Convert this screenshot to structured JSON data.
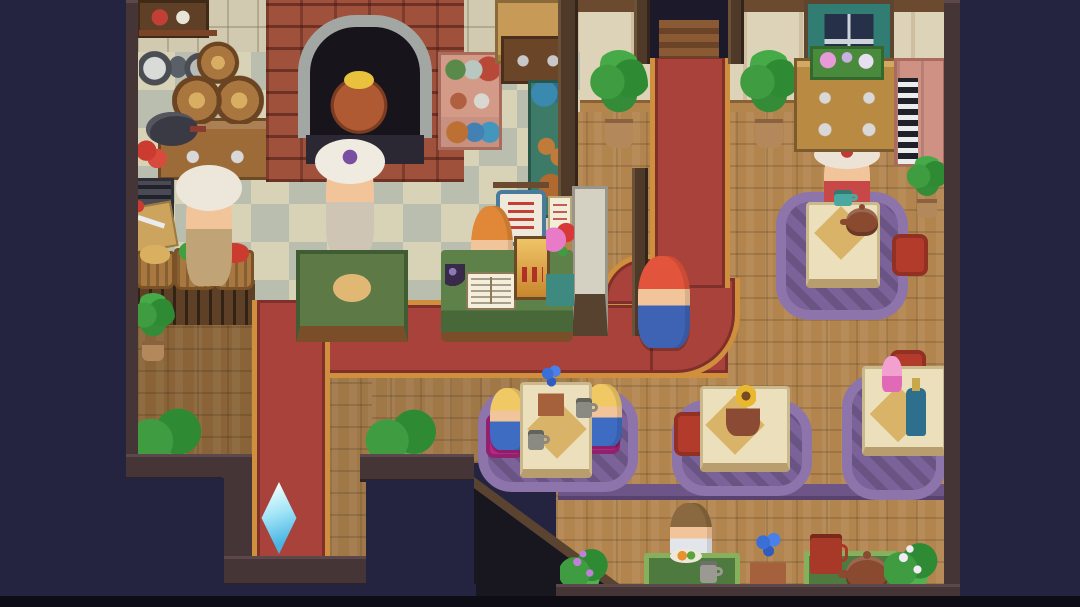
{
  "meta": {
    "scene": "pixel-art cafe-bakery interior, top-down RPG view",
    "canvas": {
      "w": 1080,
      "h": 607
    },
    "background": "#242440"
  },
  "palette": {
    "outside_navy": "#242440",
    "carpet_red": "#a8423a",
    "carpet_gold": "#cf8f3c",
    "wood_floor": "#b3854e",
    "wood_floor_mid": "#a07848",
    "wood_floor_dark": "#8a6438",
    "checker_cream": "#d8d2b6",
    "checker_gray": "#b9beae",
    "rug_purple": "#7b6299",
    "table_cream": "#ecdfbb",
    "cushion_red": "#b23b2c",
    "cushion_magenta": "#b32886",
    "mat_green": "#4e7a40",
    "crystal_cyan": "#9fe4f6",
    "border_wall": "#463536"
  },
  "sprites": [
    {
      "name": "kitchen-backsplash-wall",
      "kind": "wall-tile",
      "x": 137,
      "y": 0,
      "w": 443,
      "h": 118,
      "i": false
    },
    {
      "name": "dining-wall",
      "kind": "wall-panel",
      "x": 575,
      "y": 0,
      "w": 370,
      "h": 118,
      "i": false
    },
    {
      "name": "ceiling-beam",
      "kind": "beam",
      "x": 575,
      "y": 0,
      "w": 370,
      "h": 12,
      "i": false
    },
    {
      "name": "dining-baseboard",
      "kind": "baseboard",
      "x": 575,
      "y": 100,
      "w": 370,
      "h": 18,
      "i": false
    },
    {
      "name": "kitchen-checker-floor",
      "kind": "floor-checker",
      "x": 137,
      "y": 52,
      "w": 443,
      "h": 251,
      "i": false
    },
    {
      "name": "dining-wood-floor",
      "kind": "floor-wood",
      "x": 556,
      "y": 112,
      "w": 389,
      "h": 473,
      "i": false,
      "c": {
        "c1": "#b3854e"
      }
    },
    {
      "name": "mid-wood-floor",
      "kind": "floor-wood",
      "x": 330,
      "y": 375,
      "w": 250,
      "h": 88,
      "i": false,
      "c": {
        "c1": "#a07848"
      }
    },
    {
      "name": "branchside-wood-floor",
      "kind": "floor-wood",
      "x": 330,
      "y": 375,
      "w": 42,
      "h": 185,
      "i": false,
      "c": {
        "c1": "#a07848"
      }
    },
    {
      "name": "left-wood-floor",
      "kind": "floor-wood",
      "x": 137,
      "y": 300,
      "w": 115,
      "h": 160,
      "i": false,
      "c": {
        "c1": "#8a6438"
      }
    },
    {
      "name": "veg-counter-kickpanel",
      "kind": "counter-front",
      "x": 137,
      "y": 280,
      "w": 118,
      "h": 45,
      "i": false
    },
    {
      "name": "carpet-horizontal",
      "kind": "carpet carpet-h",
      "x": 252,
      "y": 300,
      "w": 476,
      "h": 78,
      "i": false
    },
    {
      "name": "carpet-outer-corner",
      "kind": "carpet carpet-corner",
      "x": 650,
      "y": 278,
      "w": 90,
      "h": 100,
      "i": false
    },
    {
      "name": "carpet-inner-curve",
      "kind": "carpet carpet-innercurve",
      "x": 600,
      "y": 254,
      "w": 52,
      "h": 50,
      "i": false
    },
    {
      "name": "carpet-vertical",
      "kind": "carpet carpet-v",
      "x": 650,
      "y": 56,
      "w": 80,
      "h": 232,
      "i": false
    },
    {
      "name": "carpet-south-branch",
      "kind": "carpet carpet-branch",
      "x": 252,
      "y": 300,
      "w": 78,
      "h": 260,
      "i": false
    },
    {
      "name": "booth-valance",
      "kind": "valance-strip",
      "x": 558,
      "y": 484,
      "w": 388,
      "h": 16,
      "i": false
    },
    {
      "name": "stairwell-void",
      "kind": "void-stairs",
      "x": 470,
      "y": 480,
      "w": 172,
      "h": 127,
      "i": false
    },
    {
      "name": "stairwell-edge",
      "kind": "diag-edge",
      "x": 470,
      "y": 474,
      "w": 214,
      "h": 9,
      "i": false
    },
    {
      "name": "rug-table-northeast",
      "kind": "rug",
      "x": 776,
      "y": 192,
      "w": 132,
      "h": 128,
      "i": false
    },
    {
      "name": "npc-fancy-lady",
      "kind": "char-hat",
      "x": 824,
      "y": 144,
      "w": 46,
      "h": 74,
      "i": true,
      "c": {
        "hair": "#ece2d6",
        "body": "#c84848",
        "trim": "#c03838"
      }
    },
    {
      "name": "table-northeast",
      "kind": "table",
      "x": 806,
      "y": 202,
      "w": 74,
      "h": 86,
      "i": false
    },
    {
      "name": "placemat-northeast",
      "kind": "diamond",
      "x": 822,
      "y": 214,
      "w": 38,
      "h": 38,
      "i": false
    },
    {
      "name": "teacup-lady",
      "kind": "mug",
      "x": 834,
      "y": 190,
      "w": 18,
      "h": 16,
      "i": false,
      "c": {
        "c1": "#4aa8a0"
      }
    },
    {
      "name": "teapot-northeast",
      "kind": "pot",
      "x": 846,
      "y": 208,
      "w": 32,
      "h": 28,
      "i": false,
      "c": {
        "c1": "#8a4a30"
      }
    },
    {
      "name": "cushion-northeast",
      "kind": "cushion",
      "x": 892,
      "y": 234,
      "w": 36,
      "h": 42,
      "i": false,
      "c": {
        "c1": "#b23b2c"
      }
    },
    {
      "name": "rug-table-twins",
      "kind": "rug",
      "x": 478,
      "y": 390,
      "w": 160,
      "h": 102,
      "i": false
    },
    {
      "name": "cushion-twin-left",
      "kind": "cushion",
      "x": 486,
      "y": 414,
      "w": 38,
      "h": 44,
      "i": false,
      "c": {
        "c1": "#b32886"
      }
    },
    {
      "name": "cushion-twin-right",
      "kind": "cushion",
      "x": 582,
      "y": 410,
      "w": 38,
      "h": 44,
      "i": false,
      "c": {
        "c1": "#b32886"
      }
    },
    {
      "name": "npc-twin-girl-left",
      "kind": "char",
      "x": 490,
      "y": 388,
      "w": 38,
      "h": 62,
      "i": true,
      "c": {
        "hair": "#f0c864",
        "body": "#3e6cc2"
      }
    },
    {
      "name": "npc-twin-girl-right",
      "kind": "char",
      "x": 584,
      "y": 384,
      "w": 38,
      "h": 62,
      "i": true,
      "c": {
        "hair": "#f0c864",
        "body": "#3e6cc2"
      }
    },
    {
      "name": "table-twins",
      "kind": "table",
      "x": 520,
      "y": 382,
      "w": 72,
      "h": 96,
      "i": false
    },
    {
      "name": "placemat-twins",
      "kind": "diamond",
      "x": 536,
      "y": 408,
      "w": 42,
      "h": 42,
      "i": false
    },
    {
      "name": "flower-vase-twins",
      "kind": "vase-blue",
      "x": 538,
      "y": 362,
      "w": 26,
      "h": 54,
      "i": false
    },
    {
      "name": "mug-twin-right",
      "kind": "mug",
      "x": 576,
      "y": 398,
      "w": 16,
      "h": 20,
      "i": false,
      "c": {
        "c1": "#8a8a82"
      }
    },
    {
      "name": "mug-twin-left",
      "kind": "mug",
      "x": 528,
      "y": 430,
      "w": 16,
      "h": 20,
      "i": false,
      "c": {
        "c1": "#8a8a82"
      }
    },
    {
      "name": "rug-table-sunflower",
      "kind": "rug",
      "x": 672,
      "y": 400,
      "w": 140,
      "h": 96,
      "i": false
    },
    {
      "name": "cushion-sunflower",
      "kind": "cushion",
      "x": 674,
      "y": 412,
      "w": 38,
      "h": 44,
      "i": false,
      "c": {
        "c1": "#b23b2c"
      }
    },
    {
      "name": "table-sunflower",
      "kind": "table",
      "x": 700,
      "y": 386,
      "w": 90,
      "h": 86,
      "i": false
    },
    {
      "name": "placemat-sunflower",
      "kind": "diamond",
      "x": 714,
      "y": 404,
      "w": 42,
      "h": 42,
      "i": false
    },
    {
      "name": "sunflower-vase",
      "kind": "vase-sun",
      "x": 726,
      "y": 390,
      "w": 34,
      "h": 46,
      "i": false
    },
    {
      "name": "rug-table-parfait",
      "kind": "rug",
      "x": 842,
      "y": 374,
      "w": 104,
      "h": 126,
      "i": false
    },
    {
      "name": "cushion-parfait",
      "kind": "cushion",
      "x": 890,
      "y": 350,
      "w": 36,
      "h": 26,
      "i": false,
      "c": {
        "c1": "#b23b2c"
      }
    },
    {
      "name": "table-parfait",
      "kind": "table",
      "x": 862,
      "y": 366,
      "w": 84,
      "h": 90,
      "i": false
    },
    {
      "name": "placemat-parfait",
      "kind": "diamond",
      "x": 878,
      "y": 394,
      "w": 40,
      "h": 40,
      "i": false
    },
    {
      "name": "parfait-drink",
      "kind": "parfait",
      "x": 882,
      "y": 356,
      "w": 20,
      "h": 36,
      "i": false
    },
    {
      "name": "wine-bottle",
      "kind": "bottle",
      "x": 906,
      "y": 388,
      "w": 20,
      "h": 48,
      "i": false,
      "c": {
        "c1": "#2e6f8e"
      }
    },
    {
      "name": "wall-shelf-topleft",
      "kind": "shelf-dark",
      "x": 137,
      "y": 0,
      "w": 72,
      "h": 38,
      "i": false
    },
    {
      "name": "utensil-rack",
      "kind": "utensils",
      "x": 139,
      "y": 30,
      "w": 78,
      "h": 66,
      "i": false
    },
    {
      "name": "left-counter",
      "kind": "counter-wood",
      "x": 158,
      "y": 118,
      "w": 112,
      "h": 62,
      "i": false
    },
    {
      "name": "wine-barrels",
      "kind": "barrels",
      "x": 172,
      "y": 40,
      "w": 92,
      "h": 84,
      "i": false
    },
    {
      "name": "frying-pan",
      "kind": "pan",
      "x": 146,
      "y": 112,
      "w": 52,
      "h": 34,
      "i": false
    },
    {
      "name": "tomato-pair",
      "kind": "tomatoes",
      "x": 136,
      "y": 140,
      "w": 32,
      "h": 28,
      "i": false
    },
    {
      "name": "floor-vent",
      "kind": "vent",
      "x": 126,
      "y": 178,
      "w": 48,
      "h": 64,
      "i": false
    },
    {
      "name": "cutting-board-knife",
      "kind": "board",
      "x": 131,
      "y": 204,
      "w": 44,
      "h": 46,
      "i": false
    },
    {
      "name": "basket-potatoes",
      "kind": "basket",
      "x": 135,
      "y": 251,
      "w": 40,
      "h": 38,
      "i": false,
      "c": {
        "veg": "#d8b060"
      }
    },
    {
      "name": "basket-cabbage",
      "kind": "basket",
      "x": 174,
      "y": 248,
      "w": 42,
      "h": 42,
      "i": false,
      "c": {
        "veg": "#3fa040"
      }
    },
    {
      "name": "basket-tomatoes",
      "kind": "basket",
      "x": 214,
      "y": 250,
      "w": 40,
      "h": 40,
      "i": false,
      "c": {
        "veg": "#cc3b30"
      }
    },
    {
      "name": "npc-head-chef",
      "kind": "char-hat",
      "x": 186,
      "y": 172,
      "w": 46,
      "h": 114,
      "i": true,
      "c": {
        "hair": "#ece7da",
        "body": "#c0a478"
      }
    },
    {
      "name": "brick-oven",
      "kind": "oven",
      "x": 266,
      "y": 0,
      "w": 198,
      "h": 182,
      "i": true
    },
    {
      "name": "copper-stew-pot",
      "kind": "pot-copper",
      "x": 322,
      "y": 66,
      "w": 74,
      "h": 68,
      "i": false
    },
    {
      "name": "npc-baker",
      "kind": "char-hat",
      "x": 326,
      "y": 146,
      "w": 48,
      "h": 112,
      "i": true,
      "c": {
        "hair": "#f0ebe0",
        "body": "#cfc5b4",
        "trim": "#7a4ea0"
      }
    },
    {
      "name": "prep-table",
      "kind": "prep-table",
      "x": 296,
      "y": 250,
      "w": 112,
      "h": 92,
      "i": false
    },
    {
      "name": "pink-jar-shelf",
      "kind": "shelf-pink",
      "x": 438,
      "y": 52,
      "w": 64,
      "h": 98,
      "i": false
    },
    {
      "name": "upper-cupboard",
      "kind": "cupboard",
      "x": 495,
      "y": 0,
      "w": 80,
      "h": 64,
      "i": false
    },
    {
      "name": "dark-cabinet",
      "kind": "cabinet-dark",
      "x": 501,
      "y": 36,
      "w": 74,
      "h": 48,
      "i": false
    },
    {
      "name": "bread-display-stand",
      "kind": "teal-bar",
      "x": 528,
      "y": 80,
      "w": 50,
      "h": 138,
      "i": false
    },
    {
      "name": "kitchen-door-post",
      "kind": "post-dark",
      "x": 558,
      "y": 0,
      "w": 20,
      "h": 210,
      "i": false
    },
    {
      "name": "stone-pillar",
      "kind": "pillar",
      "x": 572,
      "y": 186,
      "w": 36,
      "h": 150,
      "i": false
    },
    {
      "name": "sign-post",
      "kind": "post-dark",
      "x": 632,
      "y": 168,
      "w": 16,
      "h": 168,
      "i": false
    },
    {
      "name": "menu-sign",
      "kind": "sign",
      "x": 496,
      "y": 190,
      "w": 50,
      "h": 56,
      "i": true
    },
    {
      "name": "notice-paper",
      "kind": "paper",
      "x": 548,
      "y": 196,
      "w": 24,
      "h": 36,
      "i": true
    },
    {
      "name": "npc-receptionist",
      "kind": "char",
      "x": 471,
      "y": 206,
      "w": 42,
      "h": 94,
      "i": true,
      "c": {
        "hair": "#e08838",
        "body": "#4a70c8"
      }
    },
    {
      "name": "reception-counter",
      "kind": "counter-cloth",
      "x": 441,
      "y": 250,
      "w": 132,
      "h": 92,
      "i": false
    },
    {
      "name": "guest-book",
      "kind": "book",
      "x": 466,
      "y": 272,
      "w": 50,
      "h": 38,
      "i": true
    },
    {
      "name": "ink-pot",
      "kind": "ink",
      "x": 445,
      "y": 264,
      "w": 20,
      "h": 24,
      "i": false
    },
    {
      "name": "cash-register",
      "kind": "register",
      "x": 514,
      "y": 236,
      "w": 36,
      "h": 64,
      "i": true
    },
    {
      "name": "counter-flower-vase",
      "kind": "vase-flowers",
      "x": 546,
      "y": 222,
      "w": 28,
      "h": 84,
      "i": false
    },
    {
      "name": "north-doorway",
      "kind": "door-opening",
      "x": 648,
      "y": 0,
      "w": 82,
      "h": 58,
      "i": true
    },
    {
      "name": "door-frame-left",
      "kind": "post-dark",
      "x": 634,
      "y": 0,
      "w": 16,
      "h": 64,
      "i": false
    },
    {
      "name": "door-frame-right",
      "kind": "post-dark",
      "x": 728,
      "y": 0,
      "w": 16,
      "h": 64,
      "i": false
    },
    {
      "name": "palm-plant-door-left",
      "kind": "plant",
      "x": 590,
      "y": 50,
      "w": 58,
      "h": 98,
      "i": false
    },
    {
      "name": "palm-plant-door-right",
      "kind": "plant",
      "x": 740,
      "y": 50,
      "w": 58,
      "h": 98,
      "i": false
    },
    {
      "name": "curtained-window",
      "kind": "window",
      "x": 804,
      "y": 0,
      "w": 90,
      "h": 88,
      "i": false
    },
    {
      "name": "flower-dresser",
      "kind": "dresser",
      "x": 794,
      "y": 58,
      "w": 106,
      "h": 94,
      "i": false
    },
    {
      "name": "window-planter",
      "kind": "planter",
      "x": 810,
      "y": 46,
      "w": 74,
      "h": 34,
      "i": false
    },
    {
      "name": "folding-screen",
      "kind": "screen",
      "x": 894,
      "y": 58,
      "w": 52,
      "h": 108,
      "i": false
    },
    {
      "name": "piano-key-panel",
      "kind": "keys",
      "x": 898,
      "y": 78,
      "w": 20,
      "h": 86,
      "i": false
    },
    {
      "name": "corner-plant-east",
      "kind": "plant",
      "x": 906,
      "y": 156,
      "w": 42,
      "h": 62,
      "i": false
    },
    {
      "name": "npc-diner-man",
      "kind": "char",
      "x": 670,
      "y": 503,
      "w": 42,
      "h": 66,
      "i": true,
      "c": {
        "hair": "#8a6840",
        "body": "#e2e6ea"
      }
    },
    {
      "name": "bar-mat-left",
      "kind": "mat",
      "x": 644,
      "y": 553,
      "w": 96,
      "h": 38,
      "i": false
    },
    {
      "name": "food-plate",
      "kind": "plate",
      "x": 670,
      "y": 549,
      "w": 32,
      "h": 14,
      "i": false
    },
    {
      "name": "cup-diner",
      "kind": "mug",
      "x": 700,
      "y": 561,
      "w": 17,
      "h": 22,
      "i": false,
      "c": {
        "c1": "#9a9a92"
      }
    },
    {
      "name": "blue-flower-pot",
      "kind": "vase-blue",
      "x": 750,
      "y": 530,
      "w": 36,
      "h": 56,
      "i": false
    },
    {
      "name": "bar-mat-right",
      "kind": "mat",
      "x": 804,
      "y": 551,
      "w": 94,
      "h": 40,
      "i": false
    },
    {
      "name": "red-mug",
      "kind": "mug",
      "x": 810,
      "y": 534,
      "w": 32,
      "h": 40,
      "i": false,
      "c": {
        "c1": "#a83828"
      }
    },
    {
      "name": "teapot-bar",
      "kind": "pot",
      "x": 846,
      "y": 556,
      "w": 42,
      "h": 36,
      "i": false,
      "c": {
        "c1": "#8a4a30"
      }
    },
    {
      "name": "flower-bush-white",
      "kind": "bush",
      "x": 884,
      "y": 536,
      "w": 54,
      "h": 54,
      "i": false,
      "c": {
        "flower": "#f2eaf4"
      }
    },
    {
      "name": "flower-bush-purple",
      "kind": "bush",
      "x": 560,
      "y": 542,
      "w": 48,
      "h": 50,
      "i": false,
      "c": {
        "flower": "#c080d8"
      }
    },
    {
      "name": "leaf-bush-southwest",
      "kind": "bush",
      "x": 128,
      "y": 404,
      "w": 76,
      "h": 60,
      "i": false
    },
    {
      "name": "leaf-bush-southmid",
      "kind": "bush",
      "x": 365,
      "y": 406,
      "w": 74,
      "h": 56,
      "i": false
    },
    {
      "name": "kitchen-plant-pot",
      "kind": "plant",
      "x": 131,
      "y": 293,
      "w": 44,
      "h": 68,
      "i": false
    },
    {
      "name": "player-knight",
      "kind": "char",
      "x": 638,
      "y": 256,
      "w": 52,
      "h": 92,
      "i": true,
      "c": {
        "hair": "#e2543c",
        "body": "#3f63b4"
      }
    },
    {
      "name": "save-crystal",
      "kind": "crystal",
      "x": 256,
      "y": 482,
      "w": 46,
      "h": 72,
      "i": true
    },
    {
      "name": "west-wall",
      "kind": "border-wall",
      "x": 124,
      "y": 0,
      "w": 14,
      "h": 478,
      "i": false
    },
    {
      "name": "southwest-wall-step1",
      "kind": "border-wall",
      "x": 124,
      "y": 454,
      "w": 128,
      "h": 26,
      "i": false
    },
    {
      "name": "southwest-wall-step2",
      "kind": "border-wall",
      "x": 222,
      "y": 454,
      "w": 30,
      "h": 134,
      "i": false
    },
    {
      "name": "south-exit-wall",
      "kind": "border-wall",
      "x": 222,
      "y": 556,
      "w": 150,
      "h": 30,
      "i": false
    },
    {
      "name": "southmid-wall",
      "kind": "border-wall",
      "x": 360,
      "y": 454,
      "w": 114,
      "h": 28,
      "i": false
    },
    {
      "name": "east-wall",
      "kind": "border-wall",
      "x": 944,
      "y": 0,
      "w": 18,
      "h": 602,
      "i": false
    },
    {
      "name": "south-wall",
      "kind": "border-wall",
      "x": 556,
      "y": 584,
      "w": 406,
      "h": 16,
      "i": false
    },
    {
      "name": "outside-west",
      "kind": "void",
      "x": 0,
      "y": 0,
      "w": 126,
      "h": 607,
      "i": false
    },
    {
      "name": "outside-southwest",
      "kind": "void",
      "x": 0,
      "y": 478,
      "w": 224,
      "h": 129,
      "i": false
    },
    {
      "name": "outside-south-exit",
      "kind": "void",
      "x": 222,
      "y": 584,
      "w": 254,
      "h": 23,
      "i": false
    },
    {
      "name": "outside-southmid",
      "kind": "void",
      "x": 366,
      "y": 480,
      "w": 108,
      "h": 127,
      "i": false
    },
    {
      "name": "outside-east",
      "kind": "void",
      "x": 960,
      "y": 0,
      "w": 120,
      "h": 607,
      "i": false
    },
    {
      "name": "screen-bottom-letterbox",
      "kind": "void",
      "x": 0,
      "y": 596,
      "w": 1080,
      "h": 11,
      "i": false,
      "c": {
        "c1": "#0e0d15"
      }
    }
  ]
}
